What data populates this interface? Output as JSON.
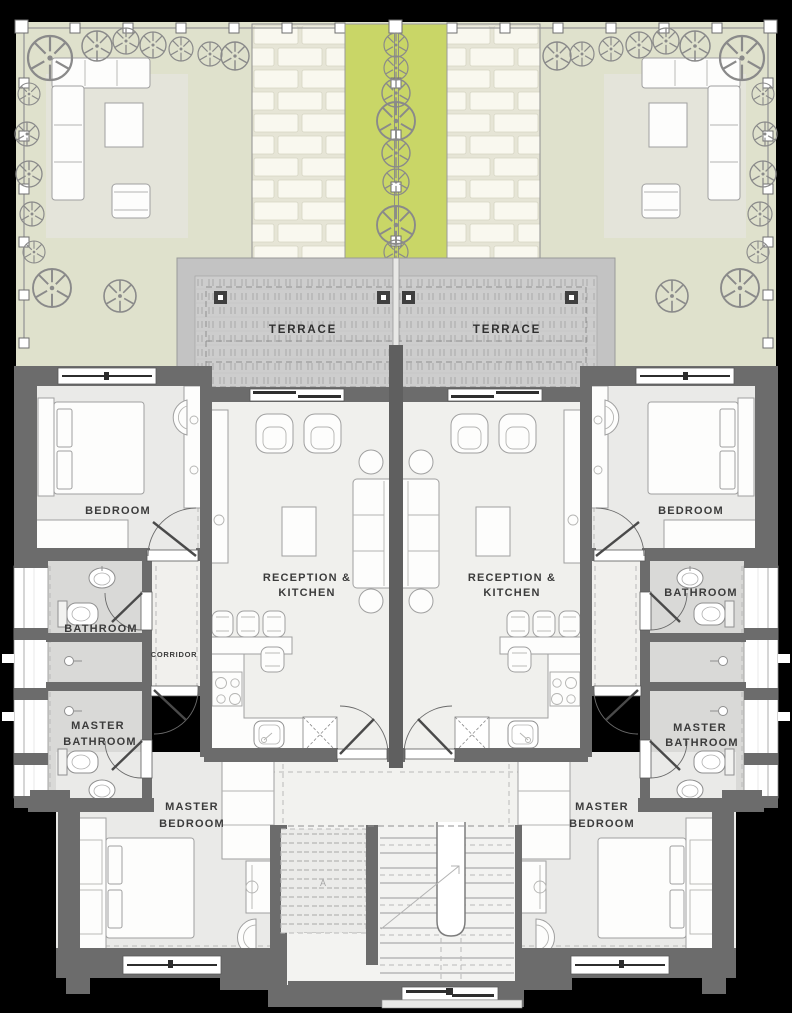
{
  "labels": {
    "terrace": "TERRACE",
    "bedroom": "BEDROOM",
    "reception1": "RECEPTION &",
    "reception2": "KITCHEN",
    "bathroom": "BATHROOM",
    "corridor": "CORRIDOR",
    "master": "MASTER",
    "stair_marker": "A"
  },
  "rooms": {
    "terrace_left": "TERRACE",
    "terrace_right": "TERRACE",
    "bedroom_left": "BEDROOM",
    "bedroom_right": "BEDROOM",
    "reception_kitchen_left": "RECEPTION & KITCHEN",
    "reception_kitchen_right": "RECEPTION & KITCHEN",
    "bathroom_left": "BATHROOM",
    "bathroom_right": "BATHROOM",
    "corridor_left": "CORRIDOR",
    "master_bathroom_left": "MASTER BATHROOM",
    "master_bathroom_right": "MASTER BATHROOM",
    "master_bedroom_left": "MASTER BEDROOM",
    "master_bedroom_right": "MASTER BEDROOM"
  },
  "colors": {
    "background": "#000000",
    "garden": "#dfe1cc",
    "patio": "#e4e4da",
    "walkway_base": "#e6e5d6",
    "walkway_brick": "#f9f8ef",
    "planted_strip": "#c9d667",
    "terrace_band": "#c3c3c3",
    "terrace_deck": "#cdcdcd",
    "wall": "#6c6c6c",
    "party_wall": "#5f5f5f",
    "room_floor": "#eaeae8",
    "reception_floor": "#f0f0ed",
    "bathroom_floor": "#d9d9d7",
    "corridor_floor": "#f1f0ed",
    "label_text": "#3b3b3b"
  }
}
